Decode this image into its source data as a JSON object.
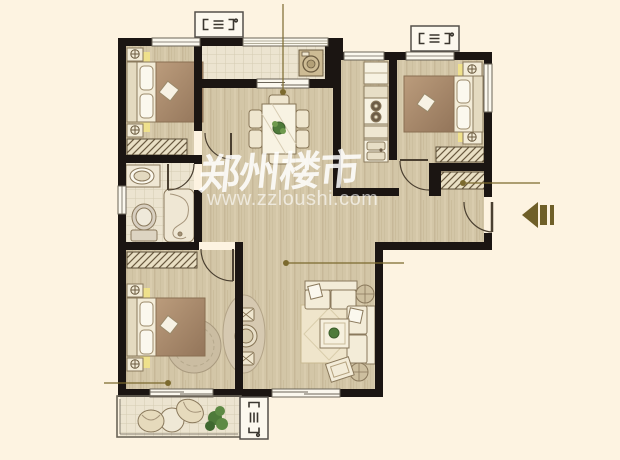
{
  "watermark": {
    "brand_cn": "郑州楼市",
    "site_url": "www.zzloushi.com"
  },
  "palette": {
    "background": "#fdf3e1",
    "wall": "#1b1512",
    "floor_wood": "#d3c6a7",
    "floor_tile": "#ece4d0",
    "accent_olive": "#7c6a2e",
    "furniture_cream": "#f3ecd8",
    "blanket_tan": "#b0906e",
    "hatch_bg": "#e9dfc4",
    "plant_green": "#4e7a3a"
  },
  "floorplan": {
    "type": "residential-floor-plan",
    "rooms": [
      {
        "id": "bedroom-top-left",
        "furniture": [
          "double-bed",
          "nightstands-with-lamps",
          "wardrobe"
        ]
      },
      {
        "id": "bathroom",
        "furniture": [
          "washbasin-counter",
          "toilet",
          "bathtub"
        ]
      },
      {
        "id": "dining-area",
        "furniture": [
          "dining-table",
          "six-chairs",
          "plant-centerpiece"
        ]
      },
      {
        "id": "laundry-balcony",
        "furniture": [
          "washing-machine"
        ]
      },
      {
        "id": "kitchen",
        "furniture": [
          "refrigerator",
          "stove",
          "double-sink",
          "counter"
        ]
      },
      {
        "id": "bedroom-top-right",
        "furniture": [
          "double-bed",
          "nightstands-with-lamps",
          "wardrobe"
        ]
      },
      {
        "id": "entry-foyer",
        "furniture": [
          "closet"
        ]
      },
      {
        "id": "living-room",
        "furniture": [
          "corner-sofa",
          "coffee-table",
          "side-tables",
          "rug",
          "tilted-tv-table"
        ]
      },
      {
        "id": "bedroom-bottom-left",
        "furniture": [
          "double-bed",
          "nightstands-with-lamps",
          "wardrobe",
          "round-rug",
          "leisure-table-two-chairs"
        ]
      },
      {
        "id": "south-balcony",
        "furniture": [
          "lounge-chairs",
          "round-table",
          "plant"
        ]
      }
    ],
    "markers": {
      "entry_arrow": "main-entrance",
      "ac_platforms": 3,
      "leader_lines": 4
    }
  }
}
